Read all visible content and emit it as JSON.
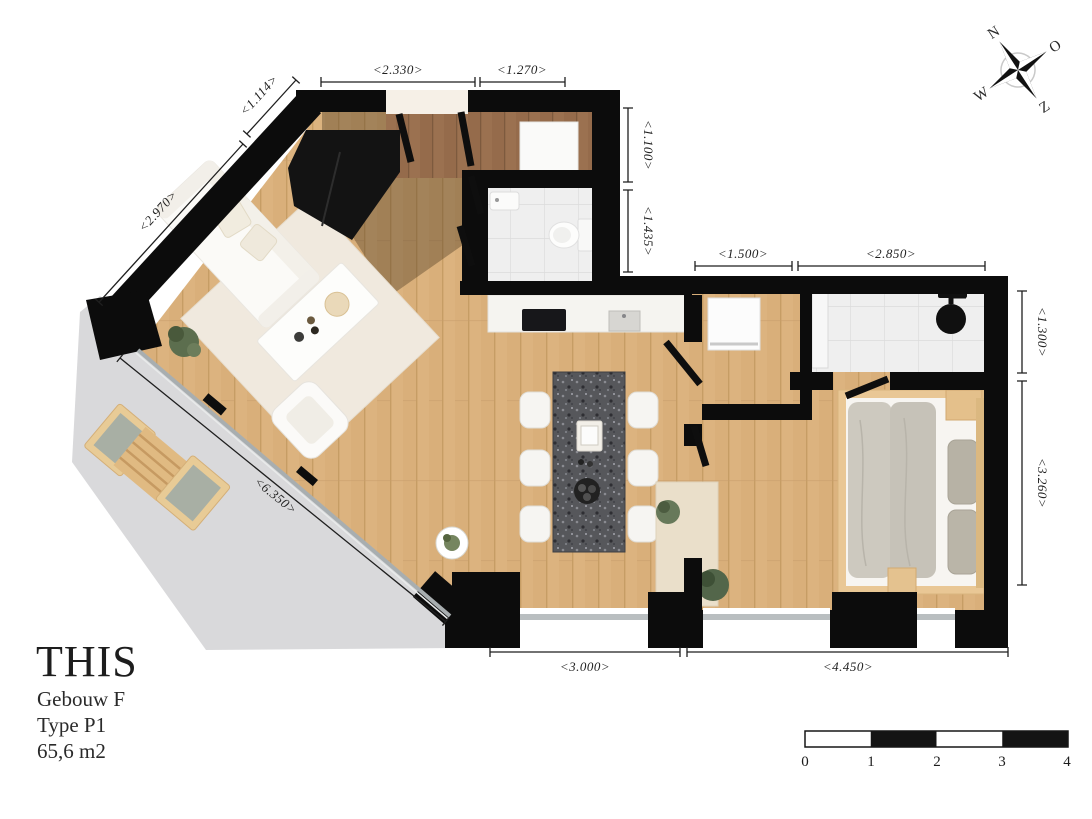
{
  "title_block": {
    "title": "THIS",
    "building": "Gebouw F",
    "unit_type": "Type P1",
    "area": "65,6 m2"
  },
  "compass": {
    "north": "N",
    "east": "O",
    "south": "Z",
    "west": "W"
  },
  "scale_bar": {
    "ticks": [
      "0",
      "1",
      "2",
      "3",
      "4"
    ]
  },
  "dimensions": {
    "living_top": "<2.330>",
    "hall_top": "<1.270>",
    "diagonal_upper": "<1.114>",
    "diagonal_lower": "<2.970>",
    "right_top_upper": "<1.100>",
    "right_top_lower": "<1.435>",
    "kitchen_top": "<1.500>",
    "bedroom_top": "<2.850>",
    "right_side_upper": "<1.300>",
    "right_side_lower": "<3.260>",
    "facade_diagonal": "<6.350>",
    "bottom_left": "<3.000>",
    "bottom_right": "<4.450>"
  },
  "colors": {
    "wall": "#0c0c0c",
    "wood_floor": "#dcb37f",
    "wood_floor_dark": "#9b7150",
    "tile": "#eeeeee",
    "balcony_concrete": "#d9d9db",
    "island_granite": "#56575b",
    "plant_green": "#5c6e4e"
  }
}
